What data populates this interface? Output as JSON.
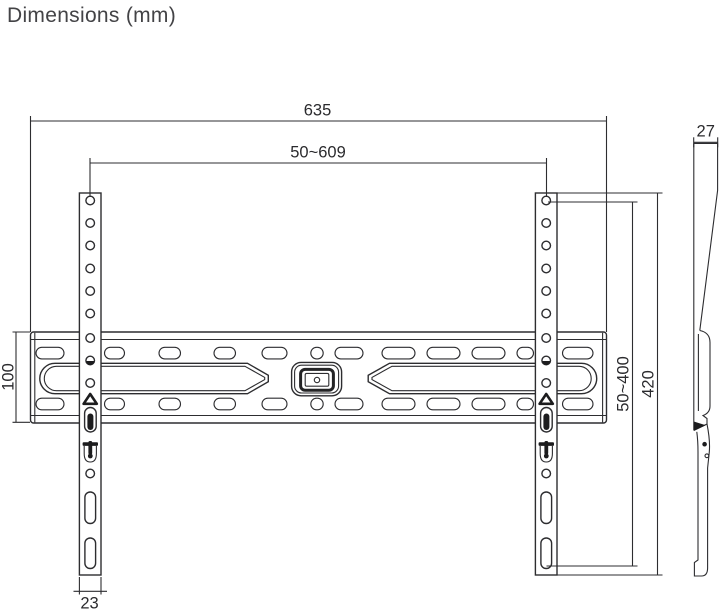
{
  "title": "Dimensions (mm)",
  "units": "mm",
  "dimensions": {
    "total_width": "635",
    "mount_width_range": "50~609",
    "profile_depth": "27",
    "plate_height": "100",
    "mount_height_range": "50~400",
    "total_height": "420",
    "rail_width": "23"
  },
  "colors": {
    "line": "#2d2d30",
    "text": "#2b2b2e",
    "title": "#434346",
    "background": "#ffffff",
    "fill_dark": "#1c1c1e"
  }
}
